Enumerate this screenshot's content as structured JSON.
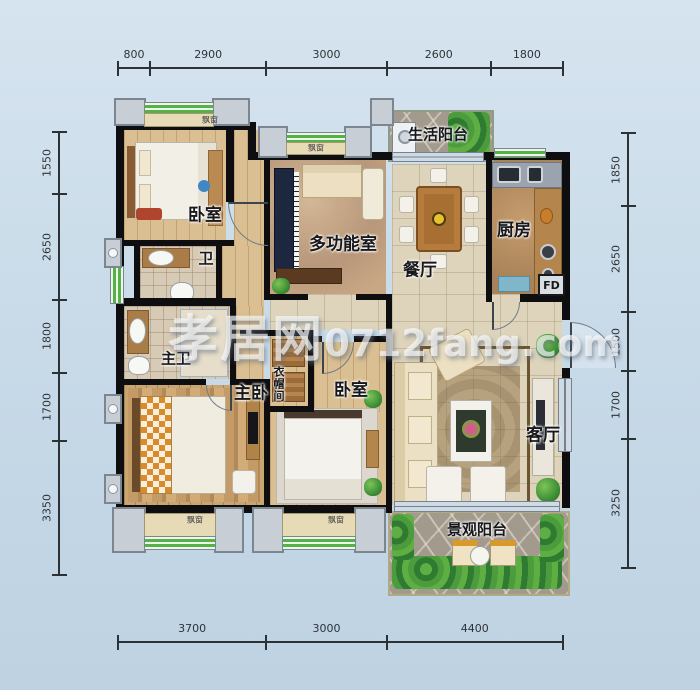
{
  "watermark": {
    "brand": "孝居网",
    "domain": "0712fang.com"
  },
  "labels": {
    "bedroom_top": "卧室",
    "bath": "卫",
    "multi_function": "多功能室",
    "life_balcony": "生活阳台",
    "dining": "餐厅",
    "kitchen": "厨房",
    "flue": "FD",
    "master_bath": "主卫",
    "master_bedroom": "主卧",
    "cloakroom": "衣帽间",
    "bedroom_2": "卧室",
    "living": "客厅",
    "view_balcony": "景观阳台",
    "bay_window": "飘窗"
  },
  "dimensions": {
    "unit": "mm",
    "top": [
      800,
      2900,
      3000,
      2600,
      1800
    ],
    "bottom": [
      3700,
      3000,
      4400
    ],
    "left": [
      1550,
      2650,
      1800,
      1700,
      3350
    ],
    "right": [
      1850,
      2650,
      1500,
      1700,
      3250
    ]
  },
  "colors": {
    "background": "#c9dbe9",
    "wall": "#0e0e10",
    "bay_window_green": "#54b247",
    "dimension_line": "#2c3136",
    "watermark": "rgba(252,253,255,0.66)"
  }
}
